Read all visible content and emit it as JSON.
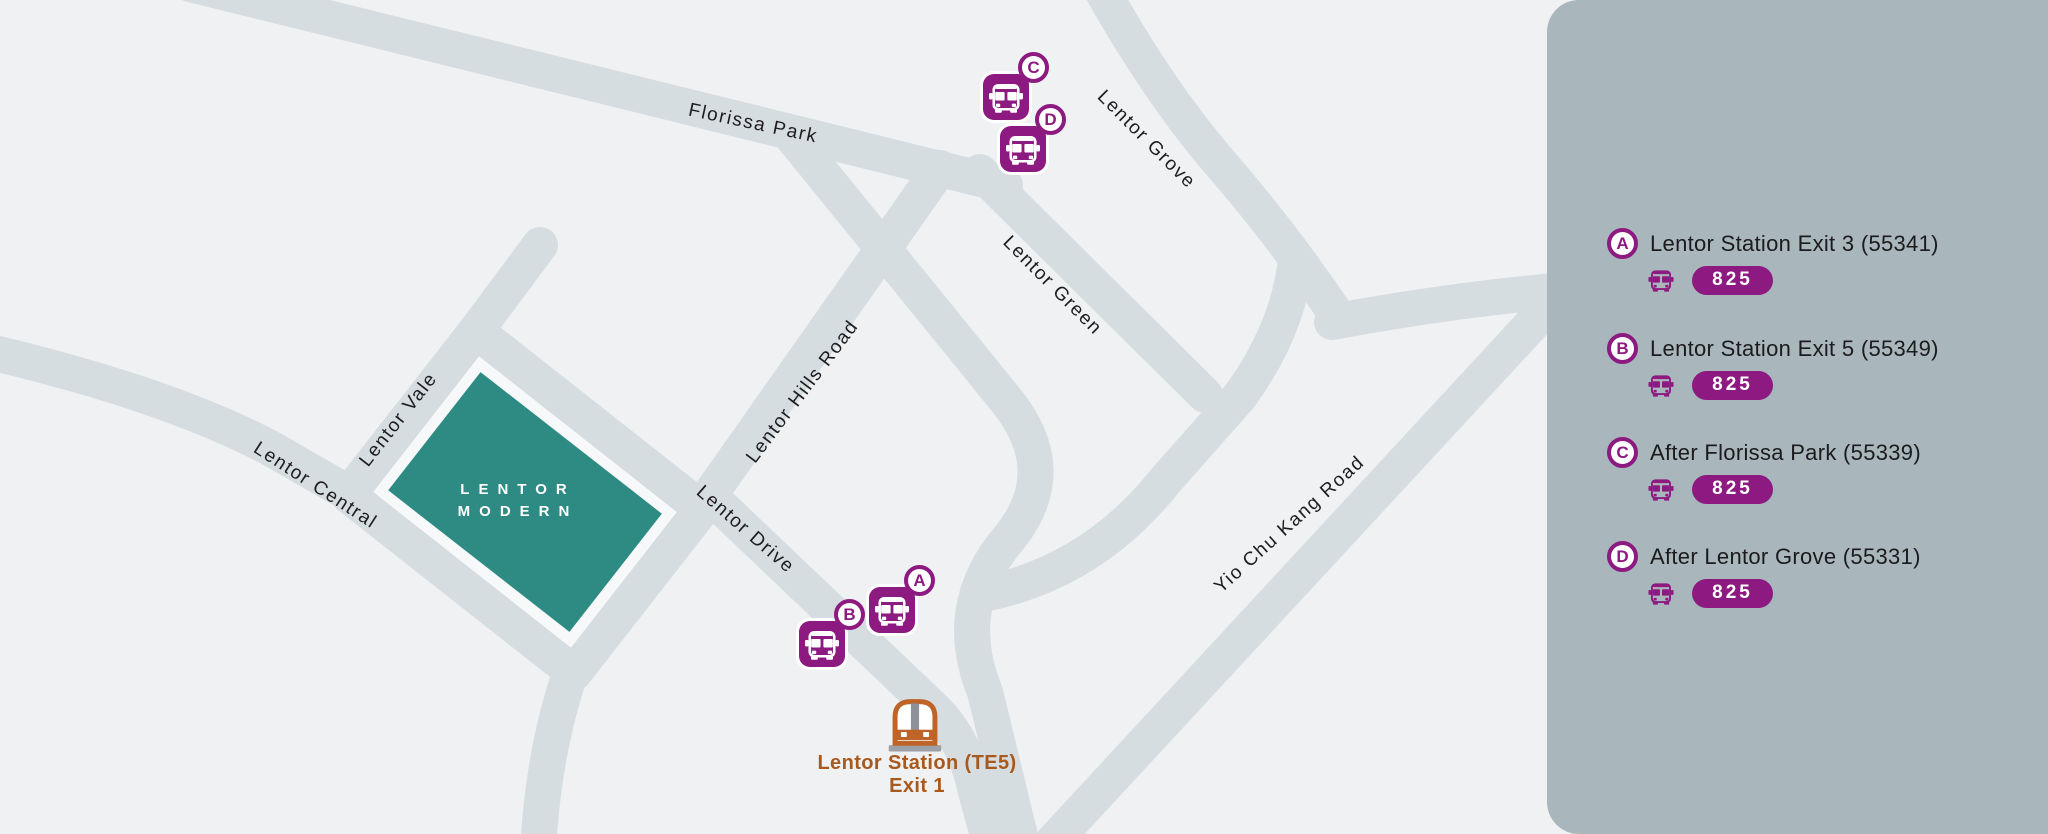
{
  "map": {
    "background_color": "#f0f1f2",
    "road_color": "#d6dde1",
    "road_labels": [
      {
        "name": "Florissa Park"
      },
      {
        "name": "Lentor Grove"
      },
      {
        "name": "Lentor Green"
      },
      {
        "name": "Lentor Hills Road"
      },
      {
        "name": "Lentor Vale"
      },
      {
        "name": "Lentor Central"
      },
      {
        "name": "Lentor Drive"
      },
      {
        "name": "Yio Chu Kang Road"
      }
    ],
    "building": {
      "line1": "LENTOR",
      "line2": "MODERN",
      "color": "#2e8b84"
    },
    "station": {
      "line1": "Lentor Station (TE5)",
      "line2": "Exit 1",
      "accent_color": "#bf6428"
    },
    "stops": [
      {
        "letter": "A"
      },
      {
        "letter": "B"
      },
      {
        "letter": "C"
      },
      {
        "letter": "D"
      }
    ]
  },
  "legend": {
    "panel_color": "#a9b6bc",
    "accent_color": "#8c1a80",
    "items": [
      {
        "letter": "A",
        "label": "Lentor Station Exit 3 (55341)",
        "bus": "825"
      },
      {
        "letter": "B",
        "label": "Lentor Station Exit 5 (55349)",
        "bus": "825"
      },
      {
        "letter": "C",
        "label": "After Florissa Park (55339)",
        "bus": "825"
      },
      {
        "letter": "D",
        "label": "After Lentor Grove (55331)",
        "bus": "825"
      }
    ]
  }
}
